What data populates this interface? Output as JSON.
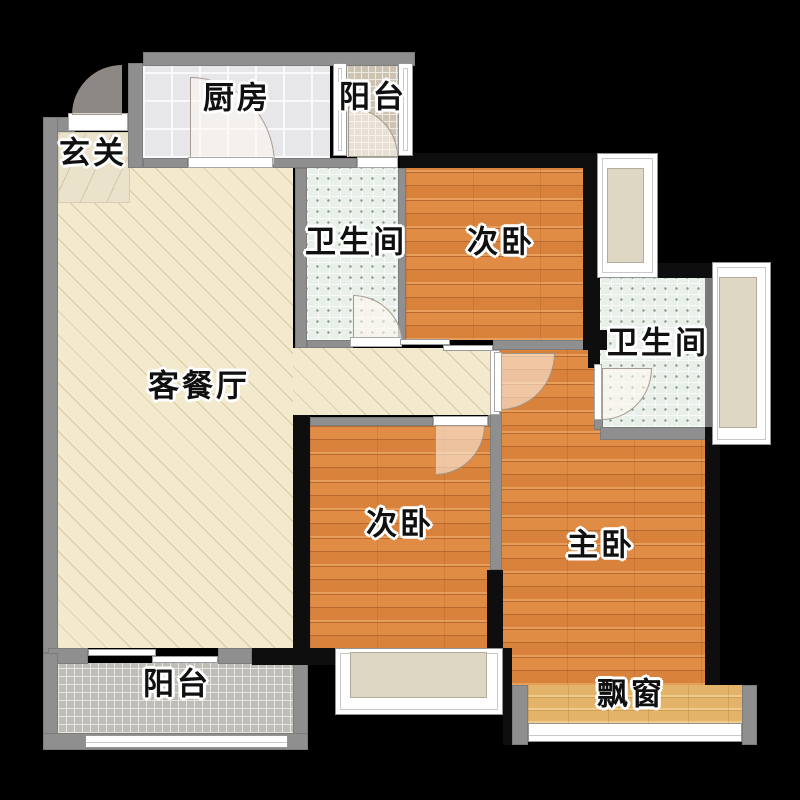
{
  "rooms": {
    "entrance": {
      "label": "玄关"
    },
    "kitchen": {
      "label": "厨房"
    },
    "balcony_top": {
      "label": "阳台"
    },
    "bathroom_left": {
      "label": "卫生间"
    },
    "bedroom_top": {
      "label": "次卧"
    },
    "bathroom_right": {
      "label": "卫生间"
    },
    "living_dining": {
      "label": "客餐厅"
    },
    "bedroom_bottom": {
      "label": "次卧"
    },
    "master_bedroom": {
      "label": "主卧"
    },
    "balcony_bottom": {
      "label": "阳台"
    },
    "bay_window": {
      "label": "飘窗"
    }
  },
  "colors": {
    "background": "#000000",
    "wall_gray": "#8f8f8f",
    "wall_dark": "#0e0e0e",
    "living_floor": "#f3e9cd",
    "wood_floor": "#dd8a45",
    "bay_wood": "#e9bd74",
    "bath_tile": "#e9efe9",
    "kitchen_tile": "#e7e7e9",
    "balcony_tan": "#cdc3b3",
    "balcony_gray": "#bfbdb7",
    "window_sill": "#ded7c4",
    "label_text": "#101010"
  }
}
